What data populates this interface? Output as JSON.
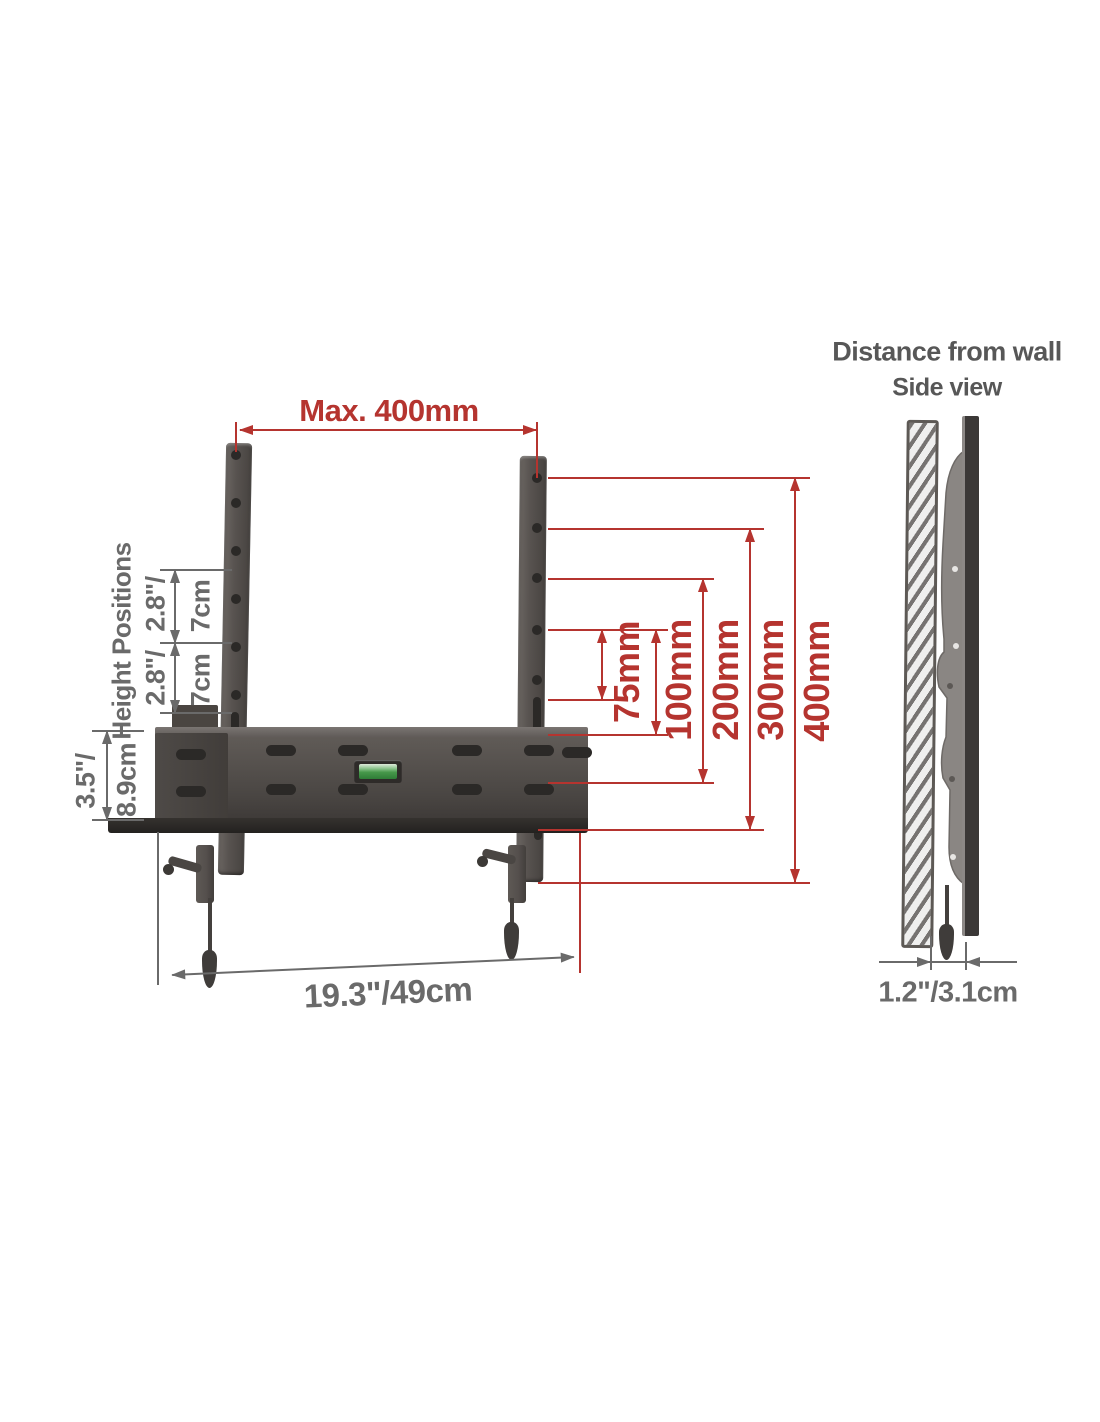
{
  "side_panel": {
    "title": "Distance from wall",
    "subtitle": "Side view",
    "depth_label": "1.2\"/3.1cm"
  },
  "front_view": {
    "max_width_label": "Max. 400mm",
    "height_positions_label": "Height Positions",
    "height_steps": [
      {
        "inches": "2.8\"/",
        "cm": "7cm"
      },
      {
        "inches": "2.8\"/",
        "cm": "7cm"
      }
    ],
    "plate_height": {
      "inches": "3.5\"/",
      "cm": "8.9cm"
    },
    "base_width_label": "19.3\"/49cm",
    "vesa_labels": [
      "75mm",
      "100mm",
      "200mm",
      "300mm",
      "400mm"
    ]
  },
  "colors": {
    "dimension_red": "#b5342f",
    "dimension_gray": "#6a6a6a",
    "title_gray": "#575757",
    "bracket_dark": "#514c49",
    "level_green": "#47984b"
  }
}
